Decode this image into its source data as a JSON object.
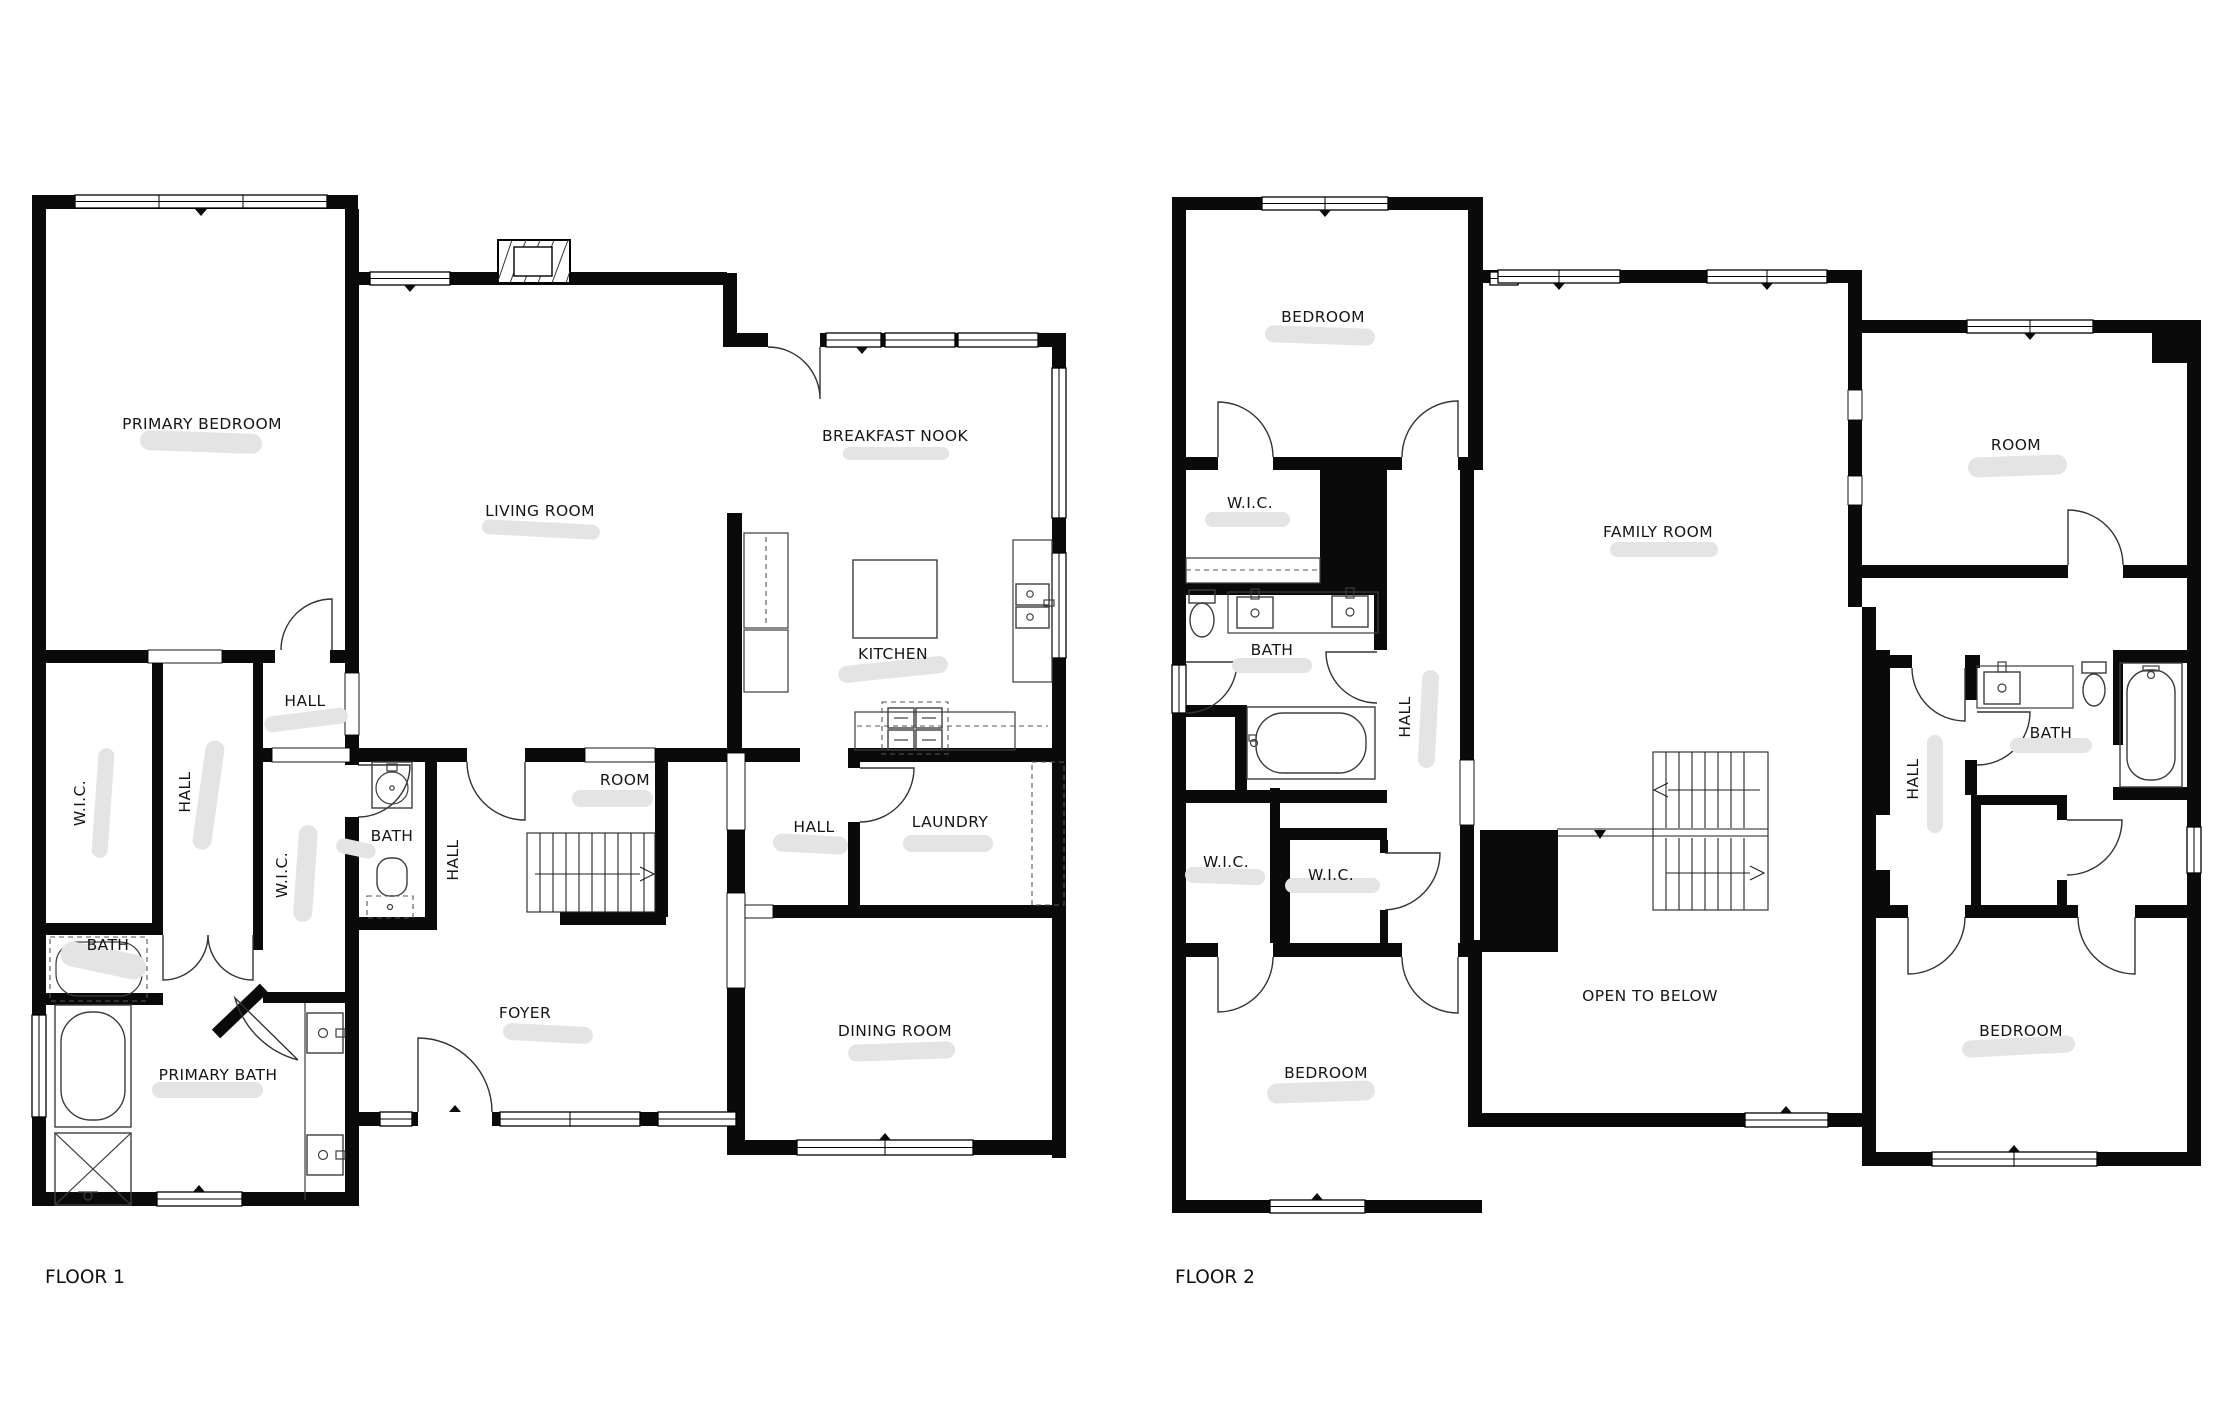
{
  "colors": {
    "wall": "#0a0a0a",
    "redaction_blur": "#e4e4e4",
    "background": "#ffffff",
    "door_line": "#333333"
  },
  "floor1": {
    "title": "FLOOR 1",
    "labels": [
      {
        "text": "PRIMARY BEDROOM"
      },
      {
        "text": "LIVING ROOM"
      },
      {
        "text": "BREAKFAST NOOK"
      },
      {
        "text": "HALL"
      },
      {
        "text": "W.I.C."
      },
      {
        "text": "HALL"
      },
      {
        "text": "W.I.C."
      },
      {
        "text": "BATH"
      },
      {
        "text": "HALL"
      },
      {
        "text": "ROOM"
      },
      {
        "text": "KITCHEN"
      },
      {
        "text": "HALL"
      },
      {
        "text": "LAUNDRY"
      },
      {
        "text": "BATH"
      },
      {
        "text": "PRIMARY BATH"
      },
      {
        "text": "FOYER"
      },
      {
        "text": "DINING ROOM"
      }
    ]
  },
  "floor2": {
    "title": "FLOOR 2",
    "labels": [
      {
        "text": "BEDROOM"
      },
      {
        "text": "W.I.C."
      },
      {
        "text": "FAMILY ROOM"
      },
      {
        "text": "ROOM"
      },
      {
        "text": "BATH"
      },
      {
        "text": "HALL"
      },
      {
        "text": "W.I.C."
      },
      {
        "text": "W.I.C."
      },
      {
        "text": "BATH"
      },
      {
        "text": "HALL"
      },
      {
        "text": "OPEN TO BELOW"
      },
      {
        "text": "BEDROOM"
      },
      {
        "text": "BEDROOM"
      }
    ]
  }
}
